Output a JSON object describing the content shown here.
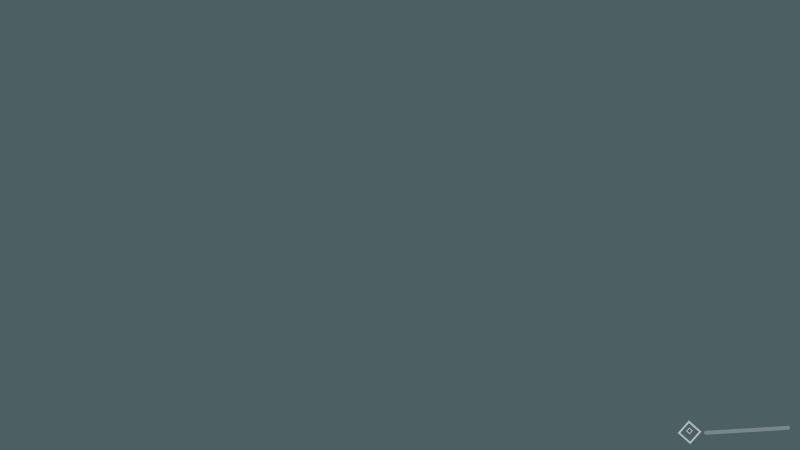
{
  "scene": {
    "kind": "aerial-3d-city-masterplan-render",
    "landmarks": {
      "main_stadium": "oval stadium with blue roof and athletics track",
      "secondary_track": "small athletics track with red lanes",
      "golf_course": "large circular golf course with bunkers and ponds",
      "tower_clusters": "white residential high-rise towers",
      "dome_pavilions": "white dome exhibition buildings in coastal park",
      "barrier_island": "long marina peninsula with piers and canal villages",
      "bay": "dark teal bay with sun glint and sailboats"
    }
  },
  "watermark": {
    "text": "Batdongsan.com.vn",
    "logo_icon": "diamond-house-icon"
  },
  "counts": {
    "sailboats": 10,
    "dome_pavilions": 4,
    "highrise_towers": 10
  },
  "colors": {
    "waterTop": "#b4bcb2",
    "waterMid": "#7d8d8c",
    "waterDeep": "#4c5f63",
    "waterDark": "#43565a",
    "glint": "#f7f8f2",
    "sandPier": "#cfc3a0",
    "beach": "#e8dfbd",
    "peninsula": "#c6b897",
    "bldDark1": "#6e675c",
    "bldDark2": "#837b6d",
    "bldDark3": "#58524a",
    "landBase": "#dbd2ba",
    "landLight": "#eae4d1",
    "road": "#4e463c",
    "roadLight": "#ddd6c1",
    "parkGreen": "#5e7440",
    "parkDark": "#45592f",
    "parkLight": "#8d9c5d",
    "lawn": "#7da352",
    "golfBase": "#5f7334",
    "golfLight": "#a2a765",
    "golfSand": "#d9d2a2",
    "pond": "#73a0a8",
    "treeGreen": "#4c6132",
    "treeRed": "#96474b",
    "bldWhite": "#f2efe4",
    "bldShade": "#b7b2a2",
    "bldEdge": "#c6c0ae",
    "blueGlass": "#4a7ab5",
    "blueCap": "#3a6399",
    "stadiumBowl": "#d8c494",
    "stadiumBowlLight": "#e7d7a9",
    "stadiumBlue": "#23427b",
    "pitch": "#6fa44b",
    "trackRed": "#bf5b39",
    "field": "#7fae56",
    "courtTan": "#d0a76b",
    "garageDark": "#3e3d3a",
    "median": "#9cab77",
    "foreground": "#b3ac9f",
    "watermark": "#ffffff"
  }
}
